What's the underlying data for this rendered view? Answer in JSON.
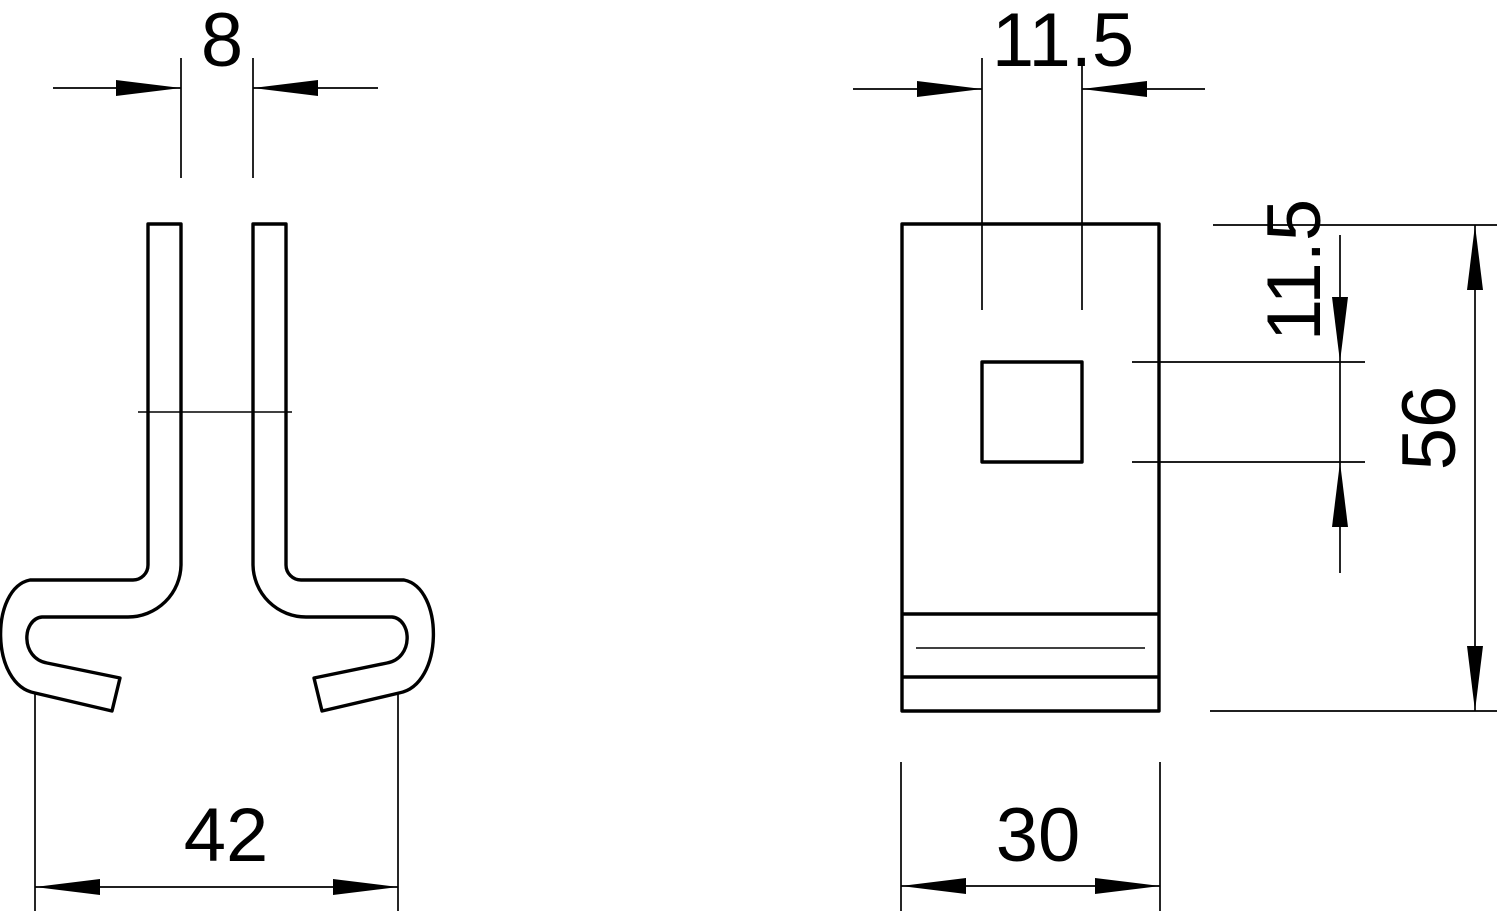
{
  "canvas": {
    "width": 1500,
    "height": 913,
    "background": "#ffffff",
    "line_color": "#000000"
  },
  "drawing": {
    "kind": "technical dimension drawing, two views of a clamp",
    "views": {
      "profile": {
        "dim_slot_width": "8",
        "dim_overall_width": "42"
      },
      "front": {
        "dim_hole_width": "11.5",
        "dim_hole_height": "11.5",
        "dim_overall_height": "56",
        "dim_overall_width": "30"
      }
    }
  }
}
